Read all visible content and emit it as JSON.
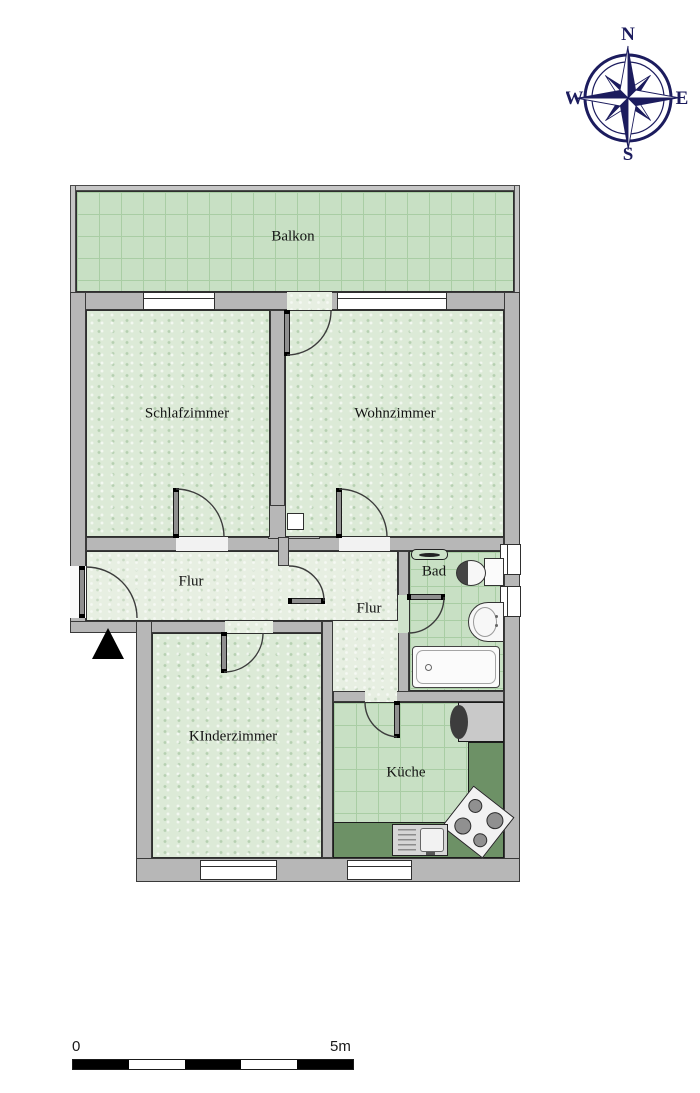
{
  "compass": {
    "north": "N",
    "east": "E",
    "south": "S",
    "west": "W"
  },
  "rooms": {
    "balkon": {
      "label": "Balkon"
    },
    "schlafzimmer": {
      "label": "Schlafzimmer"
    },
    "wohnzimmer": {
      "label": "Wohnzimmer"
    },
    "flur_left": {
      "label": "Flur"
    },
    "flur_right": {
      "label": "Flur"
    },
    "bad": {
      "label": "Bad"
    },
    "kinderzimmer": {
      "label": "KInderzimmer"
    },
    "kueche": {
      "label": "Küche"
    }
  },
  "scale_bar": {
    "start_label": "0",
    "end_label": "5m",
    "segments": 5
  },
  "colors": {
    "wall": "#b7b7b7",
    "wall_outline": "#2f2f2f",
    "carpet": "#dcead7",
    "hall_carpet": "#e7efe2",
    "tile": "#c8e0c4",
    "tile_grid": "#a9cda4",
    "counter": "#6d9166",
    "compass_navy": "#1c1c5e",
    "entrance_arrow": "#000000"
  },
  "symbols": [
    "compass-rose-icon",
    "entrance-arrow-icon",
    "bathtub-icon",
    "toilet-icon",
    "washbasin-icon",
    "radiator-icon",
    "fridge-icon",
    "stove-icon",
    "kitchen-sink-icon",
    "shaft-icon",
    "window-icon",
    "door-swing-icon"
  ]
}
